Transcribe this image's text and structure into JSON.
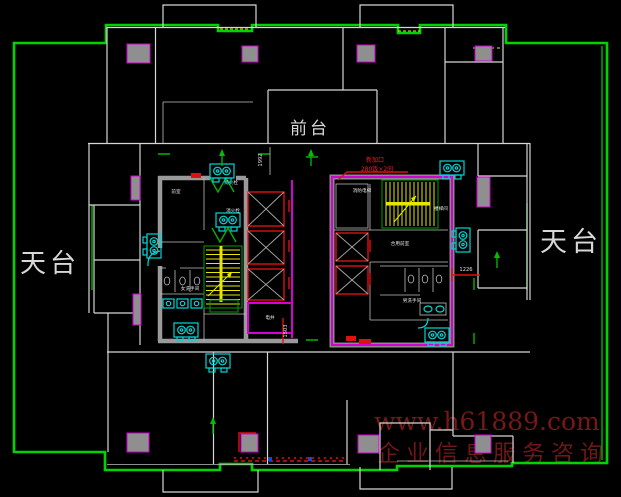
{
  "drawing": {
    "labels": {
      "rooftop_left": "天台",
      "rooftop_right": "天台",
      "front_desk": "前台"
    },
    "dimensions": {
      "dim_top_center": "1992",
      "dim_right_core": "1226",
      "dim_left_core": "1503"
    },
    "annotations": {
      "new_opening_line1": "新加口",
      "new_opening_line2": "280饭×2间"
    },
    "left_core": {
      "vestibule": "前室",
      "hydrant_top": "消火栓",
      "hydrant_mid": "消火栓",
      "womens_toilet": "女洗手间",
      "shaft_room": "电井"
    },
    "right_core": {
      "fire_elevator": "消防电梯",
      "stairwell": "楼梯间",
      "shared_lobby": "合用前室",
      "mens_toilet": "男洗手间"
    },
    "watermark": {
      "line1": "www.h61889.com",
      "line2": "企业信息服务咨询"
    },
    "colors": {
      "background": "#000000",
      "boundary_green": "#00d400",
      "wall_white": "#d6d6d6",
      "wall_gray": "#9a9a9a",
      "accent_magenta": "#d400d4",
      "elevator_red": "#dd1111",
      "stair_yellow": "#e6e600",
      "fixture_cyan": "#00d6d6",
      "watermark_red": "#8a1d1d"
    }
  }
}
